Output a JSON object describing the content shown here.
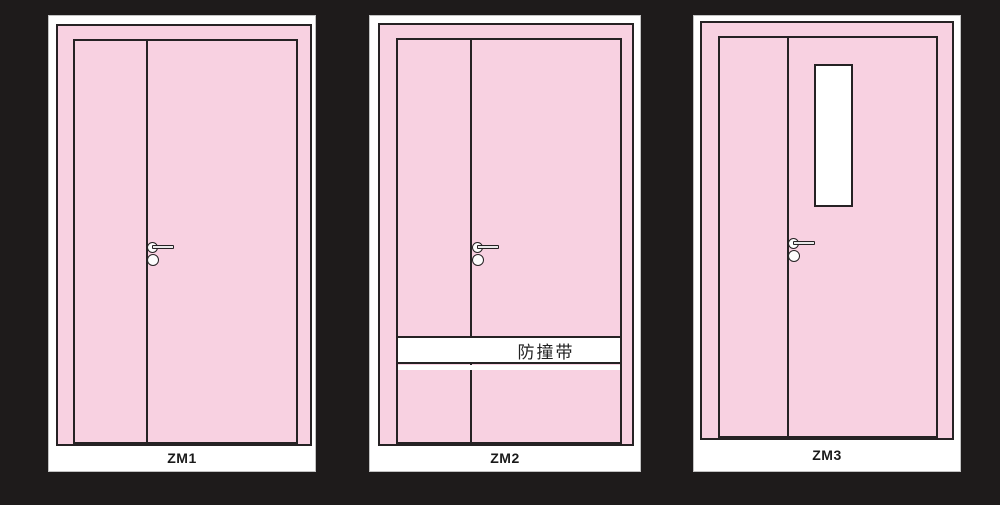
{
  "colors": {
    "background": "#1e1b1b",
    "door_pink": "#f8d1e1",
    "frame_white": "#ffffff",
    "line": "#262224",
    "label_text": "#1a1a1a"
  },
  "doors": [
    {
      "label": "ZM1"
    },
    {
      "label": "ZM2",
      "band_text": "防撞带"
    },
    {
      "label": "ZM3"
    }
  ]
}
